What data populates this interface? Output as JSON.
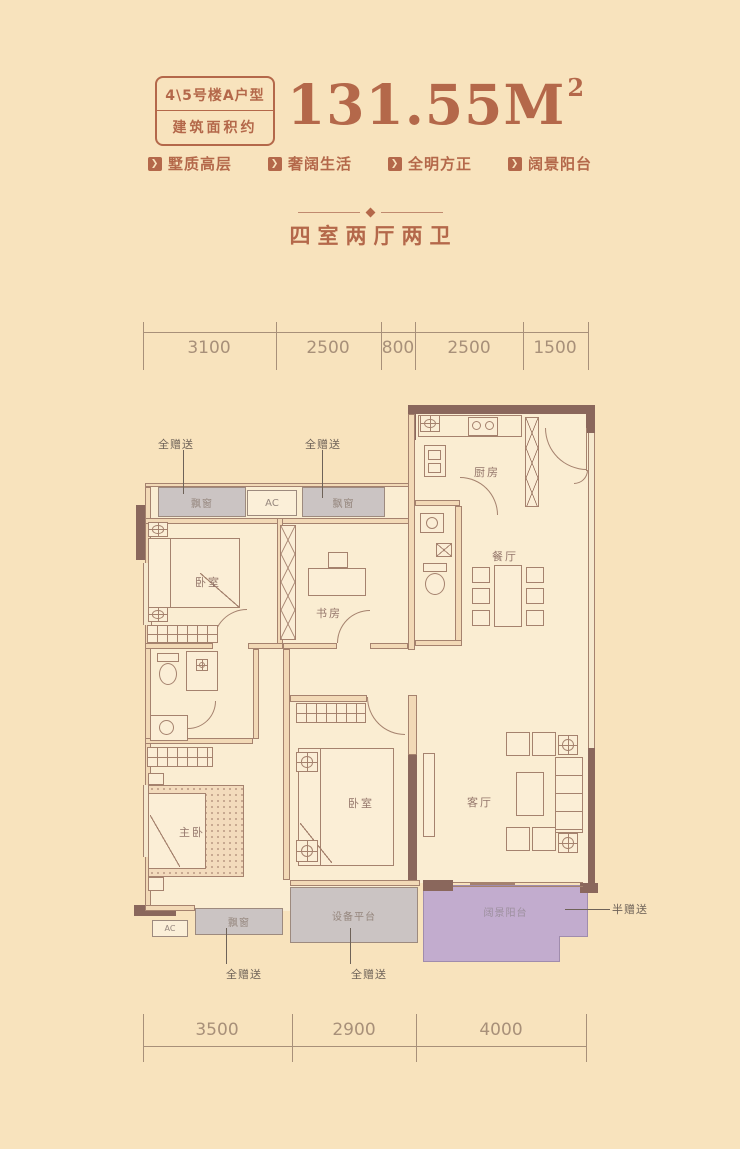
{
  "header": {
    "title_line1": "4\\5号楼A户型",
    "title_line2": "建筑面积约",
    "area_value": "131.55M",
    "area_sup": "2",
    "tags": [
      {
        "label": "墅质高层"
      },
      {
        "label": "奢阔生活"
      },
      {
        "label": "全明方正"
      },
      {
        "label": "阔景阳台"
      }
    ],
    "subtitle": "四室两厅两卫"
  },
  "dimensions": {
    "top": {
      "labels": [
        "3100",
        "2500",
        "800",
        "2500",
        "1500"
      ]
    },
    "bottom": {
      "labels": [
        "3500",
        "2900",
        "4000"
      ]
    }
  },
  "plan": {
    "rooms": {
      "bedroom1": "卧室",
      "study": "书房",
      "kitchen": "厨房",
      "dining": "餐厅",
      "master": "主卧",
      "bedroom2": "卧室",
      "living": "客厅"
    },
    "areas": {
      "bay": "飘窗",
      "ac": "AC",
      "equipment": "设备平台",
      "balcony": "阔景阳台"
    },
    "annotations": {
      "full": "全赠送",
      "half": "半赠送"
    }
  },
  "colors": {
    "accent": "#B4684A",
    "wall_dark": "#8A675C",
    "bay_gray": "#CBC4C3",
    "balcony_purple": "#C2ACCE",
    "background": "#F8E3BD"
  }
}
